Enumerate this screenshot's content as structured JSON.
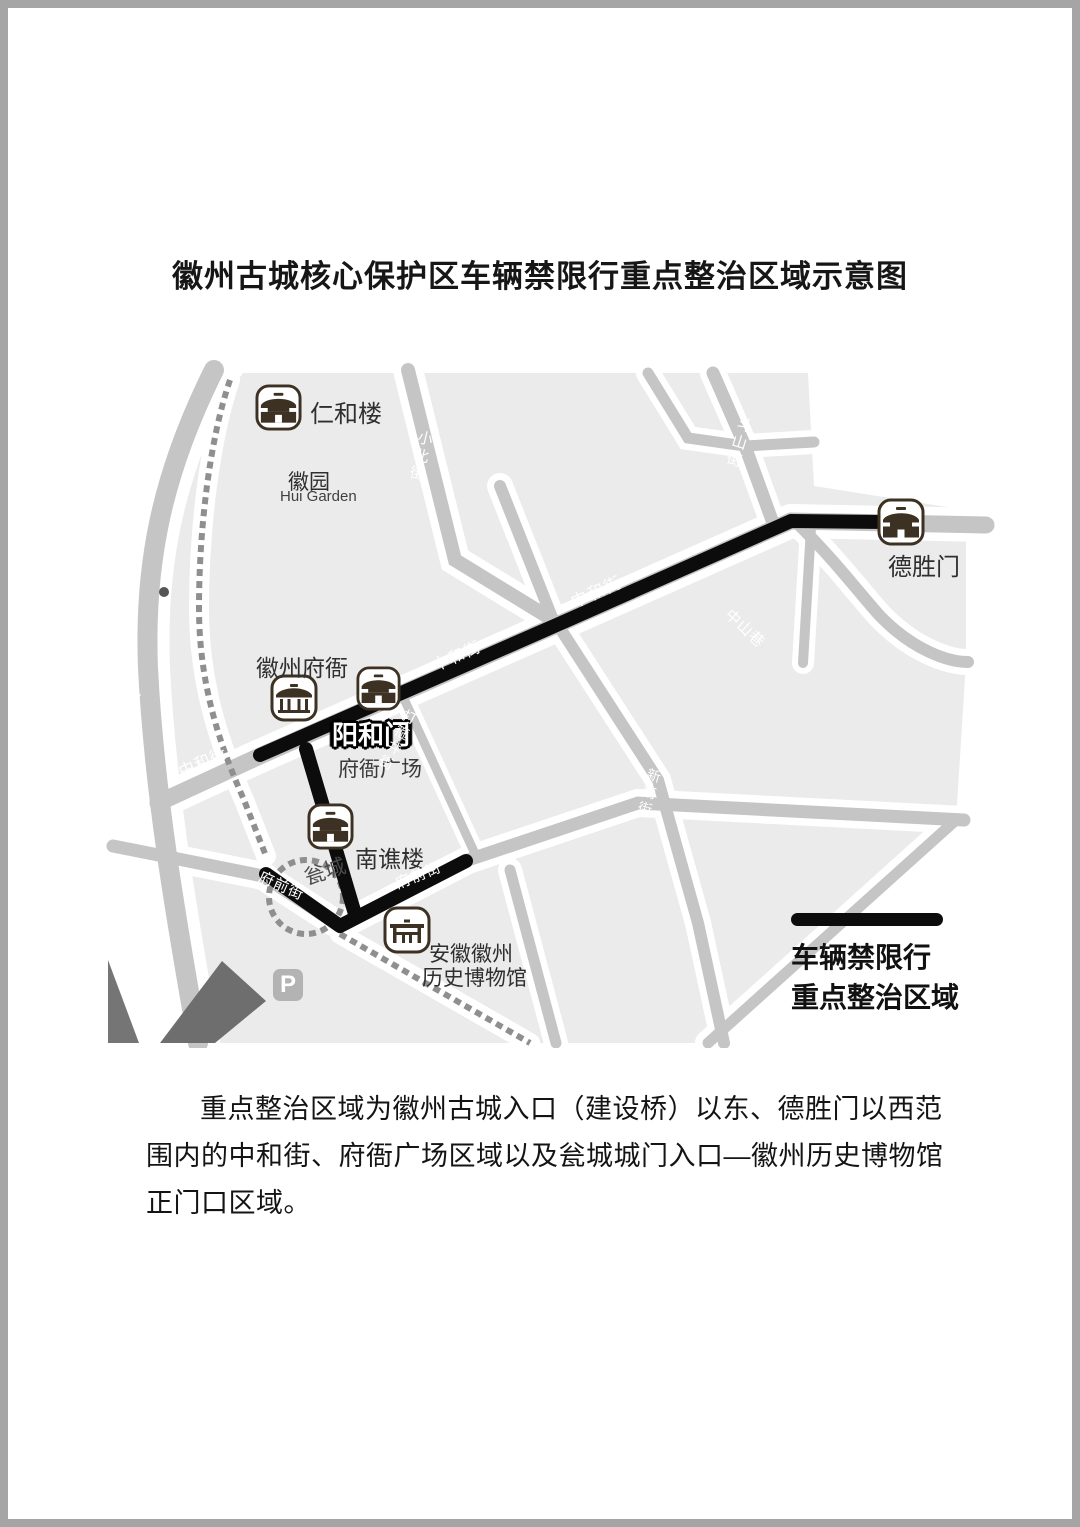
{
  "title": "徽州古城核心保护区车辆禁限行重点整治区域示意图",
  "map": {
    "pois": {
      "renhelou": "仁和楼",
      "huiyuan": "徽园",
      "huiyuan_en": "Hui Garden",
      "deshengmen": "德胜门",
      "huizhou_fuya": "徽州府衙",
      "yanghemen": "阳和门",
      "fuya_square": "府衙广场",
      "nanqiaolou": "南谯楼",
      "wengcheng": "瓮城",
      "museum_line1": "安徽徽州",
      "museum_line2": "历史博物馆",
      "parking": "P"
    },
    "streets": {
      "huizhou_road": "徽州路",
      "xiaobei_street": "小北街",
      "doushan_street": "斗山街",
      "zhongshan_lane": "中山巷",
      "zhonghe_street": "中和街",
      "dagujing_street": "打箍井街",
      "xinnan_street": "新南街",
      "fuqian_street": "府前街"
    }
  },
  "legend": {
    "line1": "车辆禁限行",
    "line2": "重点整治区域"
  },
  "description": {
    "lines": [
      "重点整治区域为徽州古城入口（建设桥）以东、德胜门以西范",
      "围内的中和街、府衙广场区域以及瓮城城门入口—徽州历史博物馆",
      "正门口区域。"
    ]
  },
  "colors": {
    "restricted_route": "#0c0c0c",
    "road": "#c5c5c5",
    "city_block": "#ebebeb",
    "icon_brown": "#3c3122",
    "city_wall": "#8f8f8f"
  }
}
